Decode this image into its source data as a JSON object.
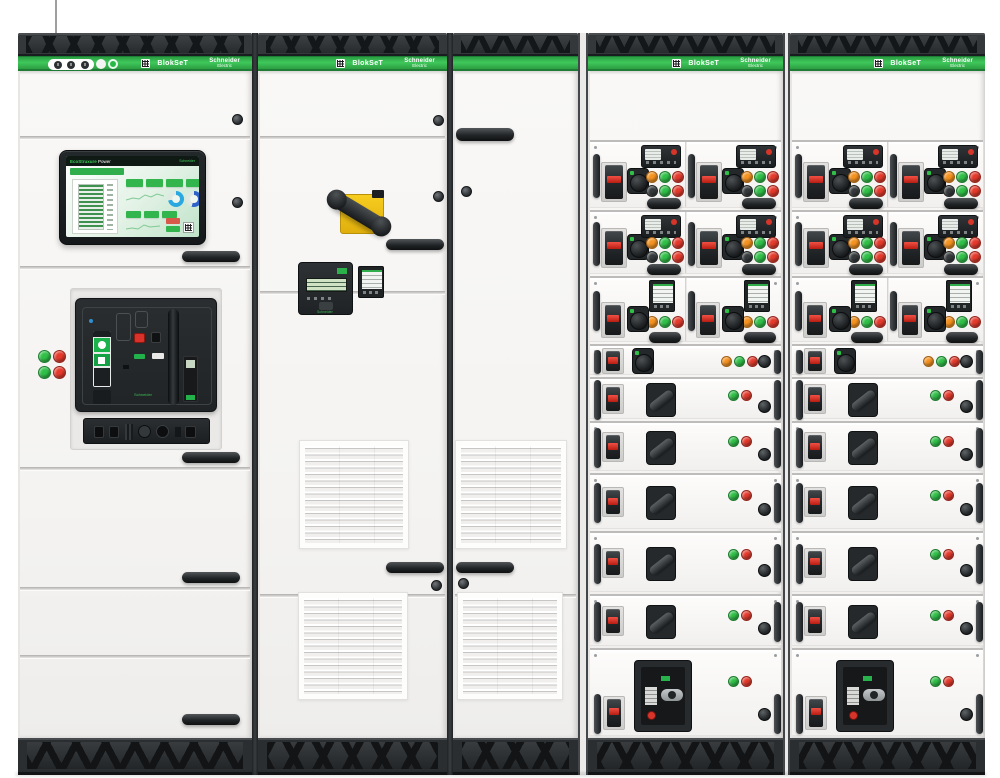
{
  "brand": {
    "product": "BlokSeT",
    "manufacturer": "Schneider",
    "manufacturer_sub": "Electric"
  },
  "palette": {
    "banner_green": "#35b04c",
    "frame_dark": "#2b2e30",
    "body_white": "#f5f4f2",
    "pilot_green": "#2fc047",
    "pilot_red": "#e5392b",
    "pilot_orange": "#f6921e",
    "switch_yellow": "#f3c713",
    "breaker_red_stripe": "#d8281c",
    "hmi_blue_gauge": "#2aa8df"
  },
  "banners": [
    {
      "product_label": "BlokSeT",
      "logo_line1": "Schneider",
      "logo_line2": "Electric",
      "locks": 3,
      "has_power_button": true,
      "has_qr": true
    },
    {
      "product_label": "BlokSeT",
      "logo_line1": "Schneider",
      "logo_line2": "Electric",
      "has_qr": true
    },
    {
      "plain": true
    },
    {
      "product_label": "BlokSeT",
      "logo_line1": "Schneider",
      "logo_line2": "Electric",
      "has_qr": true
    },
    {
      "product_label": "BlokSeT",
      "logo_line1": "Schneider",
      "logo_line2": "Electric",
      "has_qr": true
    }
  ],
  "hmi": {
    "brand": "EcoStruxure",
    "product": "Power",
    "logo": "Schneider"
  },
  "masterpact": {
    "logo": "Schneider"
  },
  "relay": {
    "logo": "Schneider"
  },
  "cab1_indicator_lights": [
    [
      "green",
      "red"
    ],
    [
      "green",
      "red"
    ]
  ],
  "drawer_columns": [
    {
      "x": 588
    },
    {
      "x": 790
    }
  ],
  "drawer_rows": [
    {
      "type": "motor_pair",
      "y": 140,
      "h": 68
    },
    {
      "type": "motor_pair",
      "y": 210,
      "h": 64
    },
    {
      "type": "meter_pair",
      "y": 276,
      "h": 66
    },
    {
      "type": "indicator",
      "y": 344,
      "h": 31,
      "lights": [
        "orange",
        "green",
        "red"
      ]
    },
    {
      "type": "pistol",
      "y": 377,
      "h": 42,
      "lights": [
        "green",
        "red"
      ]
    },
    {
      "type": "pistol",
      "y": 421,
      "h": 50,
      "lights": [
        "green",
        "red"
      ]
    },
    {
      "type": "pistol",
      "y": 473,
      "h": 56,
      "lights": [
        "green",
        "red"
      ]
    },
    {
      "type": "pistol",
      "y": 531,
      "h": 61,
      "lights": [
        "green",
        "red"
      ]
    },
    {
      "type": "pistol",
      "y": 594,
      "h": 52,
      "lights": [
        "green",
        "red"
      ]
    },
    {
      "type": "mccb",
      "y": 648,
      "h": 88,
      "lights": [
        "green",
        "red"
      ]
    }
  ],
  "motor_unit_buttons_row1": [
    "orange",
    "green",
    "red"
  ],
  "motor_unit_buttons_row2": [
    "dark",
    "green",
    "red"
  ],
  "meter_unit_buttons": [
    "orange",
    "green",
    "red"
  ]
}
